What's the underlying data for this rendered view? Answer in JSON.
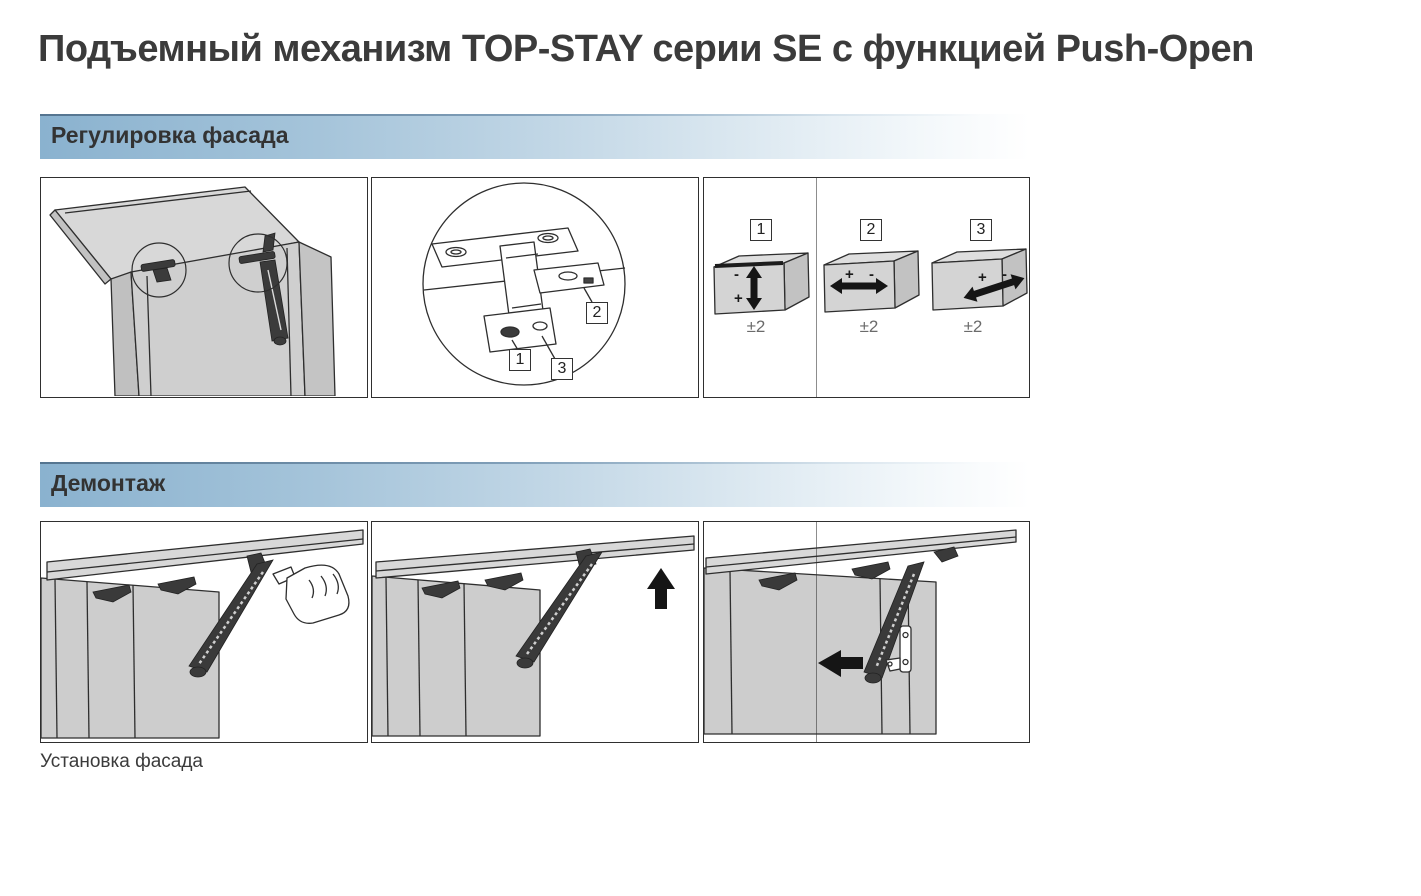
{
  "title": "Подъемный механизм TOP-STAY серии SE с функцией Push-Open",
  "sections": [
    {
      "header": "Регулировка фасада"
    },
    {
      "header": "Демонтаж"
    }
  ],
  "footer_label": "Установка фасада",
  "hinge_callouts": {
    "labels": [
      "1",
      "2",
      "3"
    ]
  },
  "adjustments": {
    "items": [
      {
        "num": "1",
        "axis": "vertical",
        "minus": "-",
        "plus": "+",
        "range": "±2"
      },
      {
        "num": "2",
        "axis": "horizontal",
        "plus": "+",
        "minus": "-",
        "range": "±2"
      },
      {
        "num": "3",
        "axis": "depth",
        "plus": "+",
        "minus": "-",
        "range": "±2"
      }
    ]
  },
  "colors": {
    "header_gradient_start": "#8ab2cf",
    "header_gradient_end": "#ffffff",
    "header_top_border": "#54748f",
    "panel_border": "#2f2f2f",
    "cabinet_gray": "#cdcdcd",
    "lid_gray": "#d8d8d8",
    "hardware_dark": "#3a3a3a",
    "arrow_black": "#151515",
    "text_dark": "#3a3a3a",
    "range_gray": "#6b6b6b"
  },
  "icons": [
    "magnifier-circle-icon",
    "up-down-adjust-arrow-icon",
    "left-right-adjust-arrow-icon",
    "depth-adjust-arrow-icon",
    "up-arrow-icon",
    "left-arrow-icon",
    "hand-pointing-icon"
  ]
}
